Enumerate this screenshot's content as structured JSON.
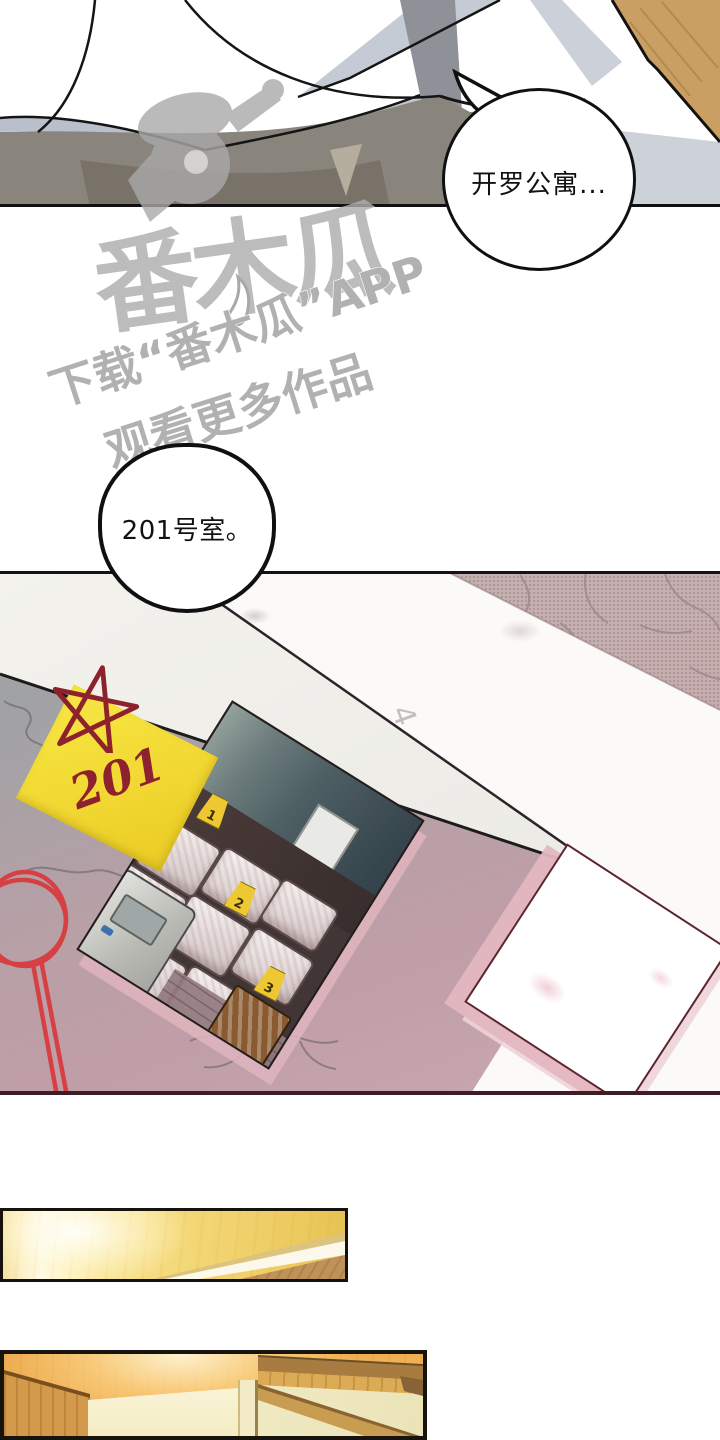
{
  "bubbles": {
    "b1": "开罗公寓...",
    "b2": "201号室。"
  },
  "watermark": {
    "logo": "番木瓜",
    "tagline1": "下载“番木瓜”APP",
    "tagline2": "观看更多作品"
  },
  "panel2": {
    "sticky_note": "201",
    "photo_markers": [
      "1",
      "2",
      "3"
    ],
    "paper_hint": "4"
  },
  "colors": {
    "note_yellow": "#f2d832",
    "doodle_red": "#d64045",
    "star_red": "#8e222c",
    "wood": "#c99f63",
    "panel_border": "#101010",
    "panel2_bottom_border": "#3f1d26"
  }
}
